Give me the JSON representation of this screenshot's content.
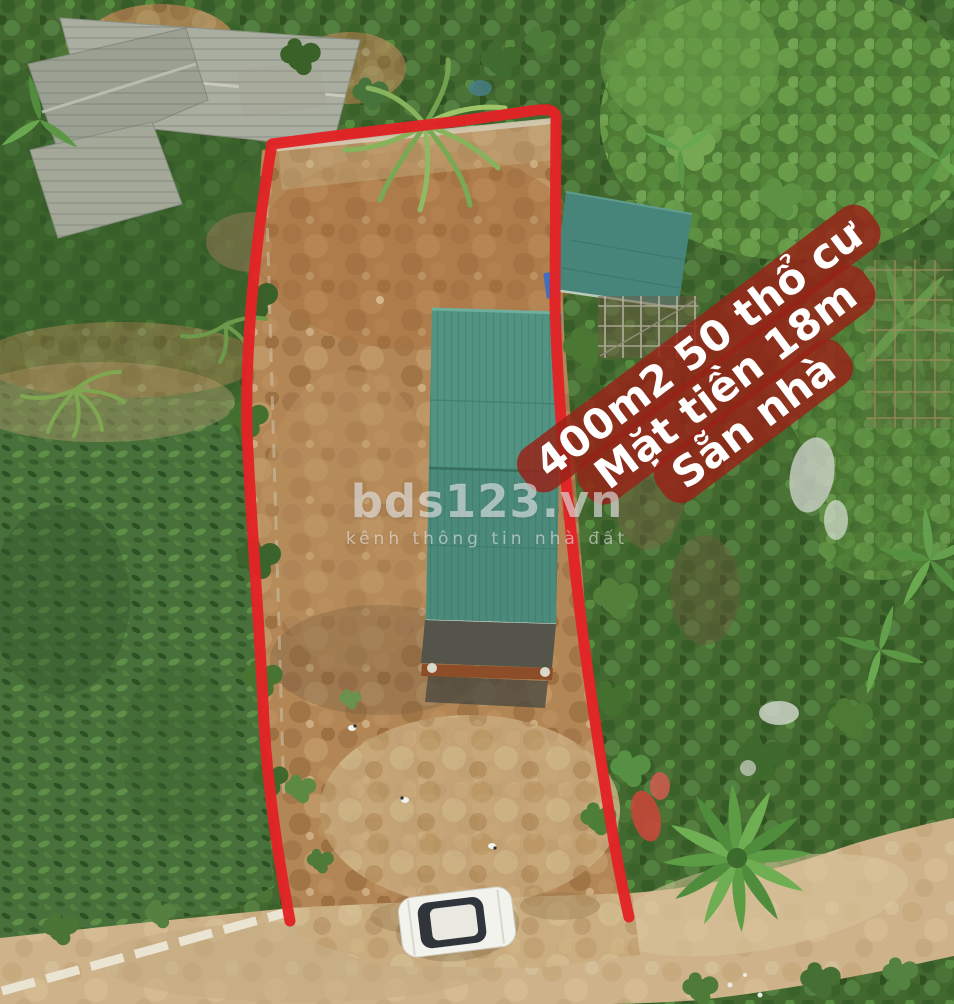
{
  "banner": {
    "lines": [
      "400m2 50 thổ cư",
      "Mặt tiền 18m",
      "Sẵn nhà"
    ],
    "bg_color": "#97231a",
    "text_color": "#ffffff"
  },
  "watermark": {
    "brand": "bds123.vn",
    "tagline": "kênh thông tin nhà đất",
    "color": "#fafafc"
  },
  "scene": {
    "type": "aerial-drone-photo",
    "subject": "land plot for sale outlined in red",
    "boundary_color": "#e22326",
    "roof_color": "#4f8f7d",
    "dirt_color": "#b28655",
    "road_color": "#cdb28a",
    "objects": [
      "plot-boundary",
      "cleared-dirt-plot",
      "long-green-roof-building",
      "small-green-roof-building",
      "old-gray-roof-houses",
      "crop-field",
      "banana-trees",
      "dirt-road",
      "white-car",
      "chickens"
    ]
  }
}
